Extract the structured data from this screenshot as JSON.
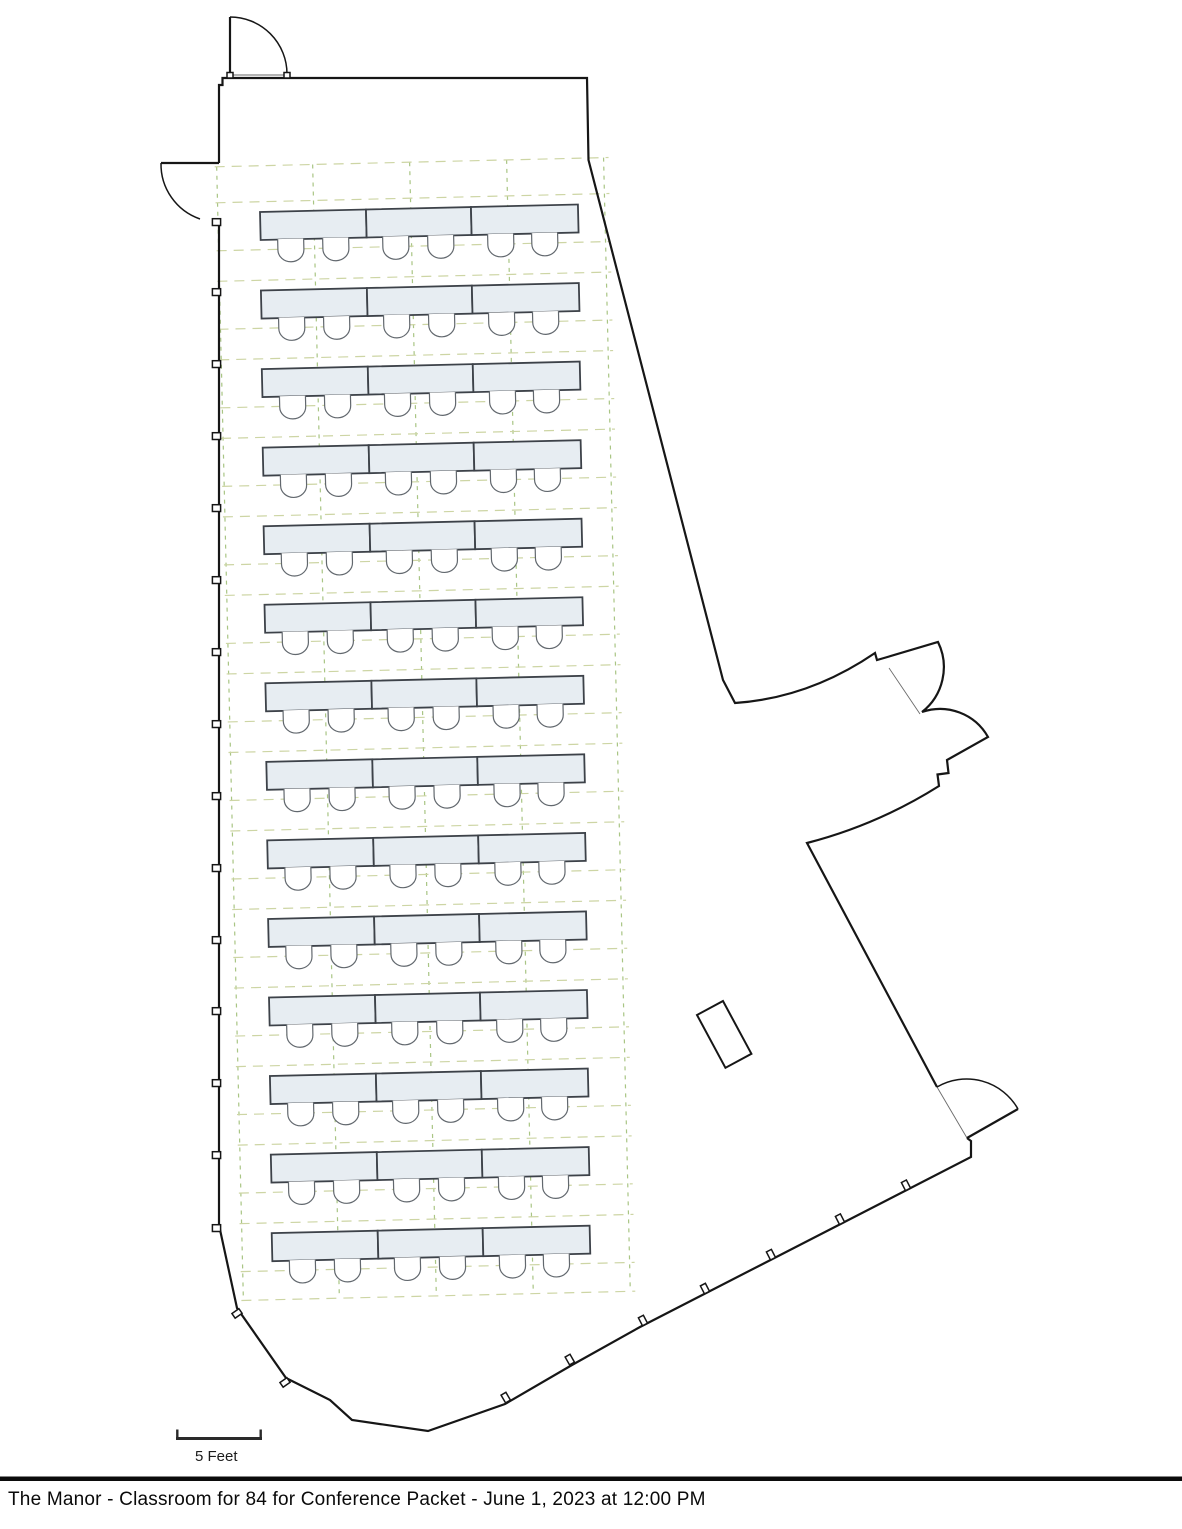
{
  "footer": {
    "title": "The Manor - Classroom for 84 for Conference Packet - June 1, 2023 at 12:00 PM"
  },
  "scale_bar": {
    "label": "5 Feet"
  },
  "floor_plan": {
    "room_name": "The Manor",
    "setup_style": "Classroom",
    "capacity": 84,
    "event": "Conference Packet",
    "event_datetime": "June 1, 2023 at 12:00 PM",
    "seating": {
      "rows": 14,
      "tables_per_row": 3,
      "chairs_per_table": 2,
      "chairs_per_row": 6,
      "total_chairs": 84,
      "total_tables": 42
    },
    "colors": {
      "wall": "#161616",
      "table_fill": "#e7edf2",
      "table_stroke": "#3d4249",
      "chair_stroke": "#62686e",
      "grid_horizontal": "#cdd5a4",
      "grid_vertical": "#a9c584",
      "background": "#ffffff"
    }
  }
}
